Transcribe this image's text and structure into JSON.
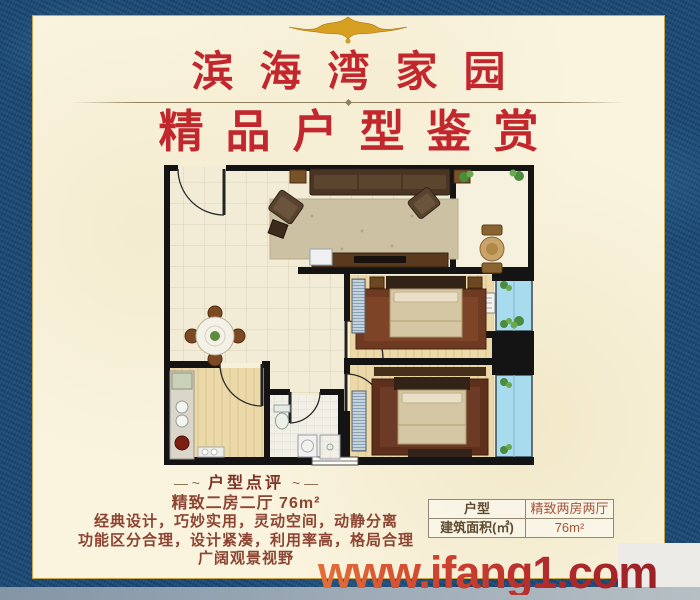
{
  "poster": {
    "title": "滨海湾家园",
    "subtitle": "精品户型鉴赏",
    "review": {
      "decor_left": "— ~",
      "decor_right": "~ —",
      "heading": "户型点评",
      "summary": "精致二房二厅 76m²",
      "lines": [
        "经典设计，巧妙实用，灵动空间，动静分离",
        "功能区分合理，设计紧凑，利用率高，格局合理",
        "广阔观景视野"
      ]
    },
    "spec_table": {
      "rows": [
        {
          "label": "户型",
          "value": "精致两房两厅"
        },
        {
          "label": "建筑面积(㎡)",
          "value": "76m²"
        }
      ]
    },
    "watermark": "www.ifang1.com",
    "colors": {
      "border_blue": "#1d4c78",
      "panel_cream": "#faf4df",
      "title_red": "#c1272d",
      "text_maroon": "#8c4532",
      "gold": "#d4a017",
      "watermark_red": "#c23327",
      "bay_window_blue": "#a9dbee"
    }
  }
}
